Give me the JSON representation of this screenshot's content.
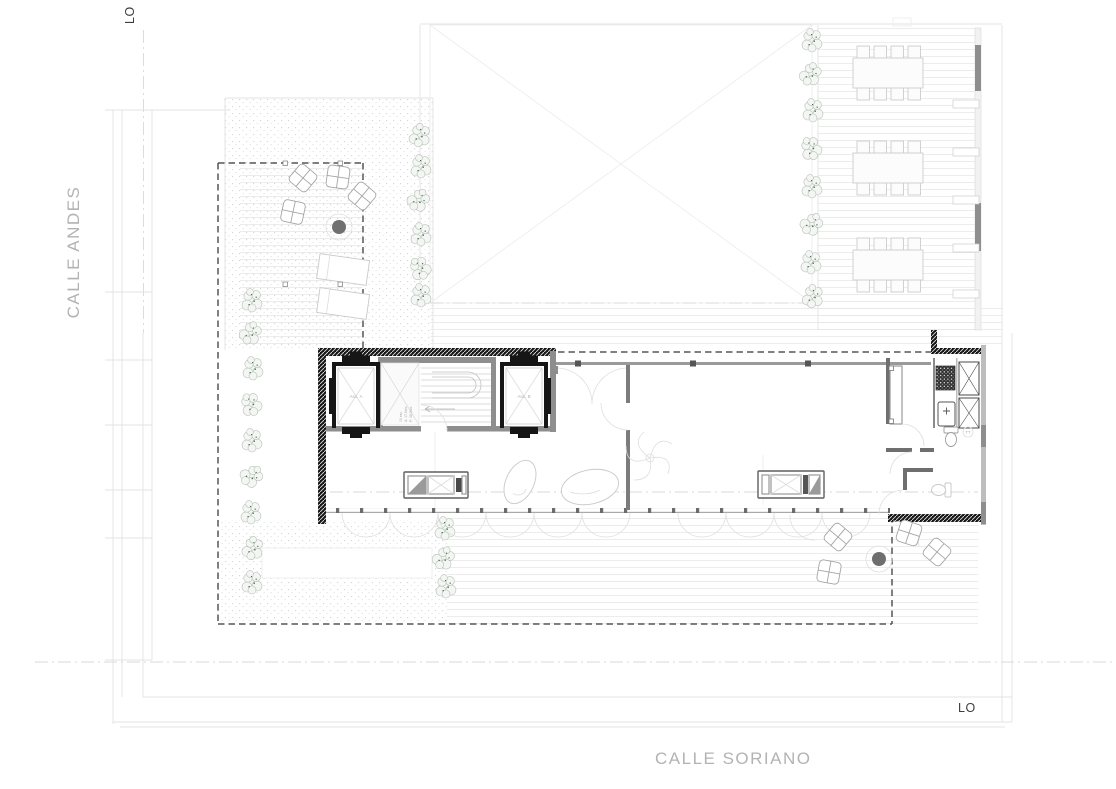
{
  "plan": {
    "title": "roof / terrace level floor plan",
    "streets": {
      "left": "CALLE ANDES",
      "bottom": "CALLE SORIANO"
    },
    "markers": {
      "lo_top": "LO",
      "lo_bottom": "LO"
    },
    "core": {
      "elevator_a": "Asc. A",
      "elevator_b": "Asc. B",
      "stair_note_1": "15 esc.",
      "stair_note_2": "A: 17,5cm",
      "stair_note_3": "P: 28,5cm"
    },
    "kitchen": {
      "fixture_label": "TT"
    },
    "colors": {
      "background": "#ffffff",
      "boundary_dash": "#565656",
      "wall_black": "#161616",
      "wall_gray": "#8e8e8e",
      "street_text": "#b3b3b3",
      "marker_text": "#3f3f3f",
      "vegetation_speck": "#4a7050",
      "furniture_dark": "#6e6e6e"
    }
  }
}
